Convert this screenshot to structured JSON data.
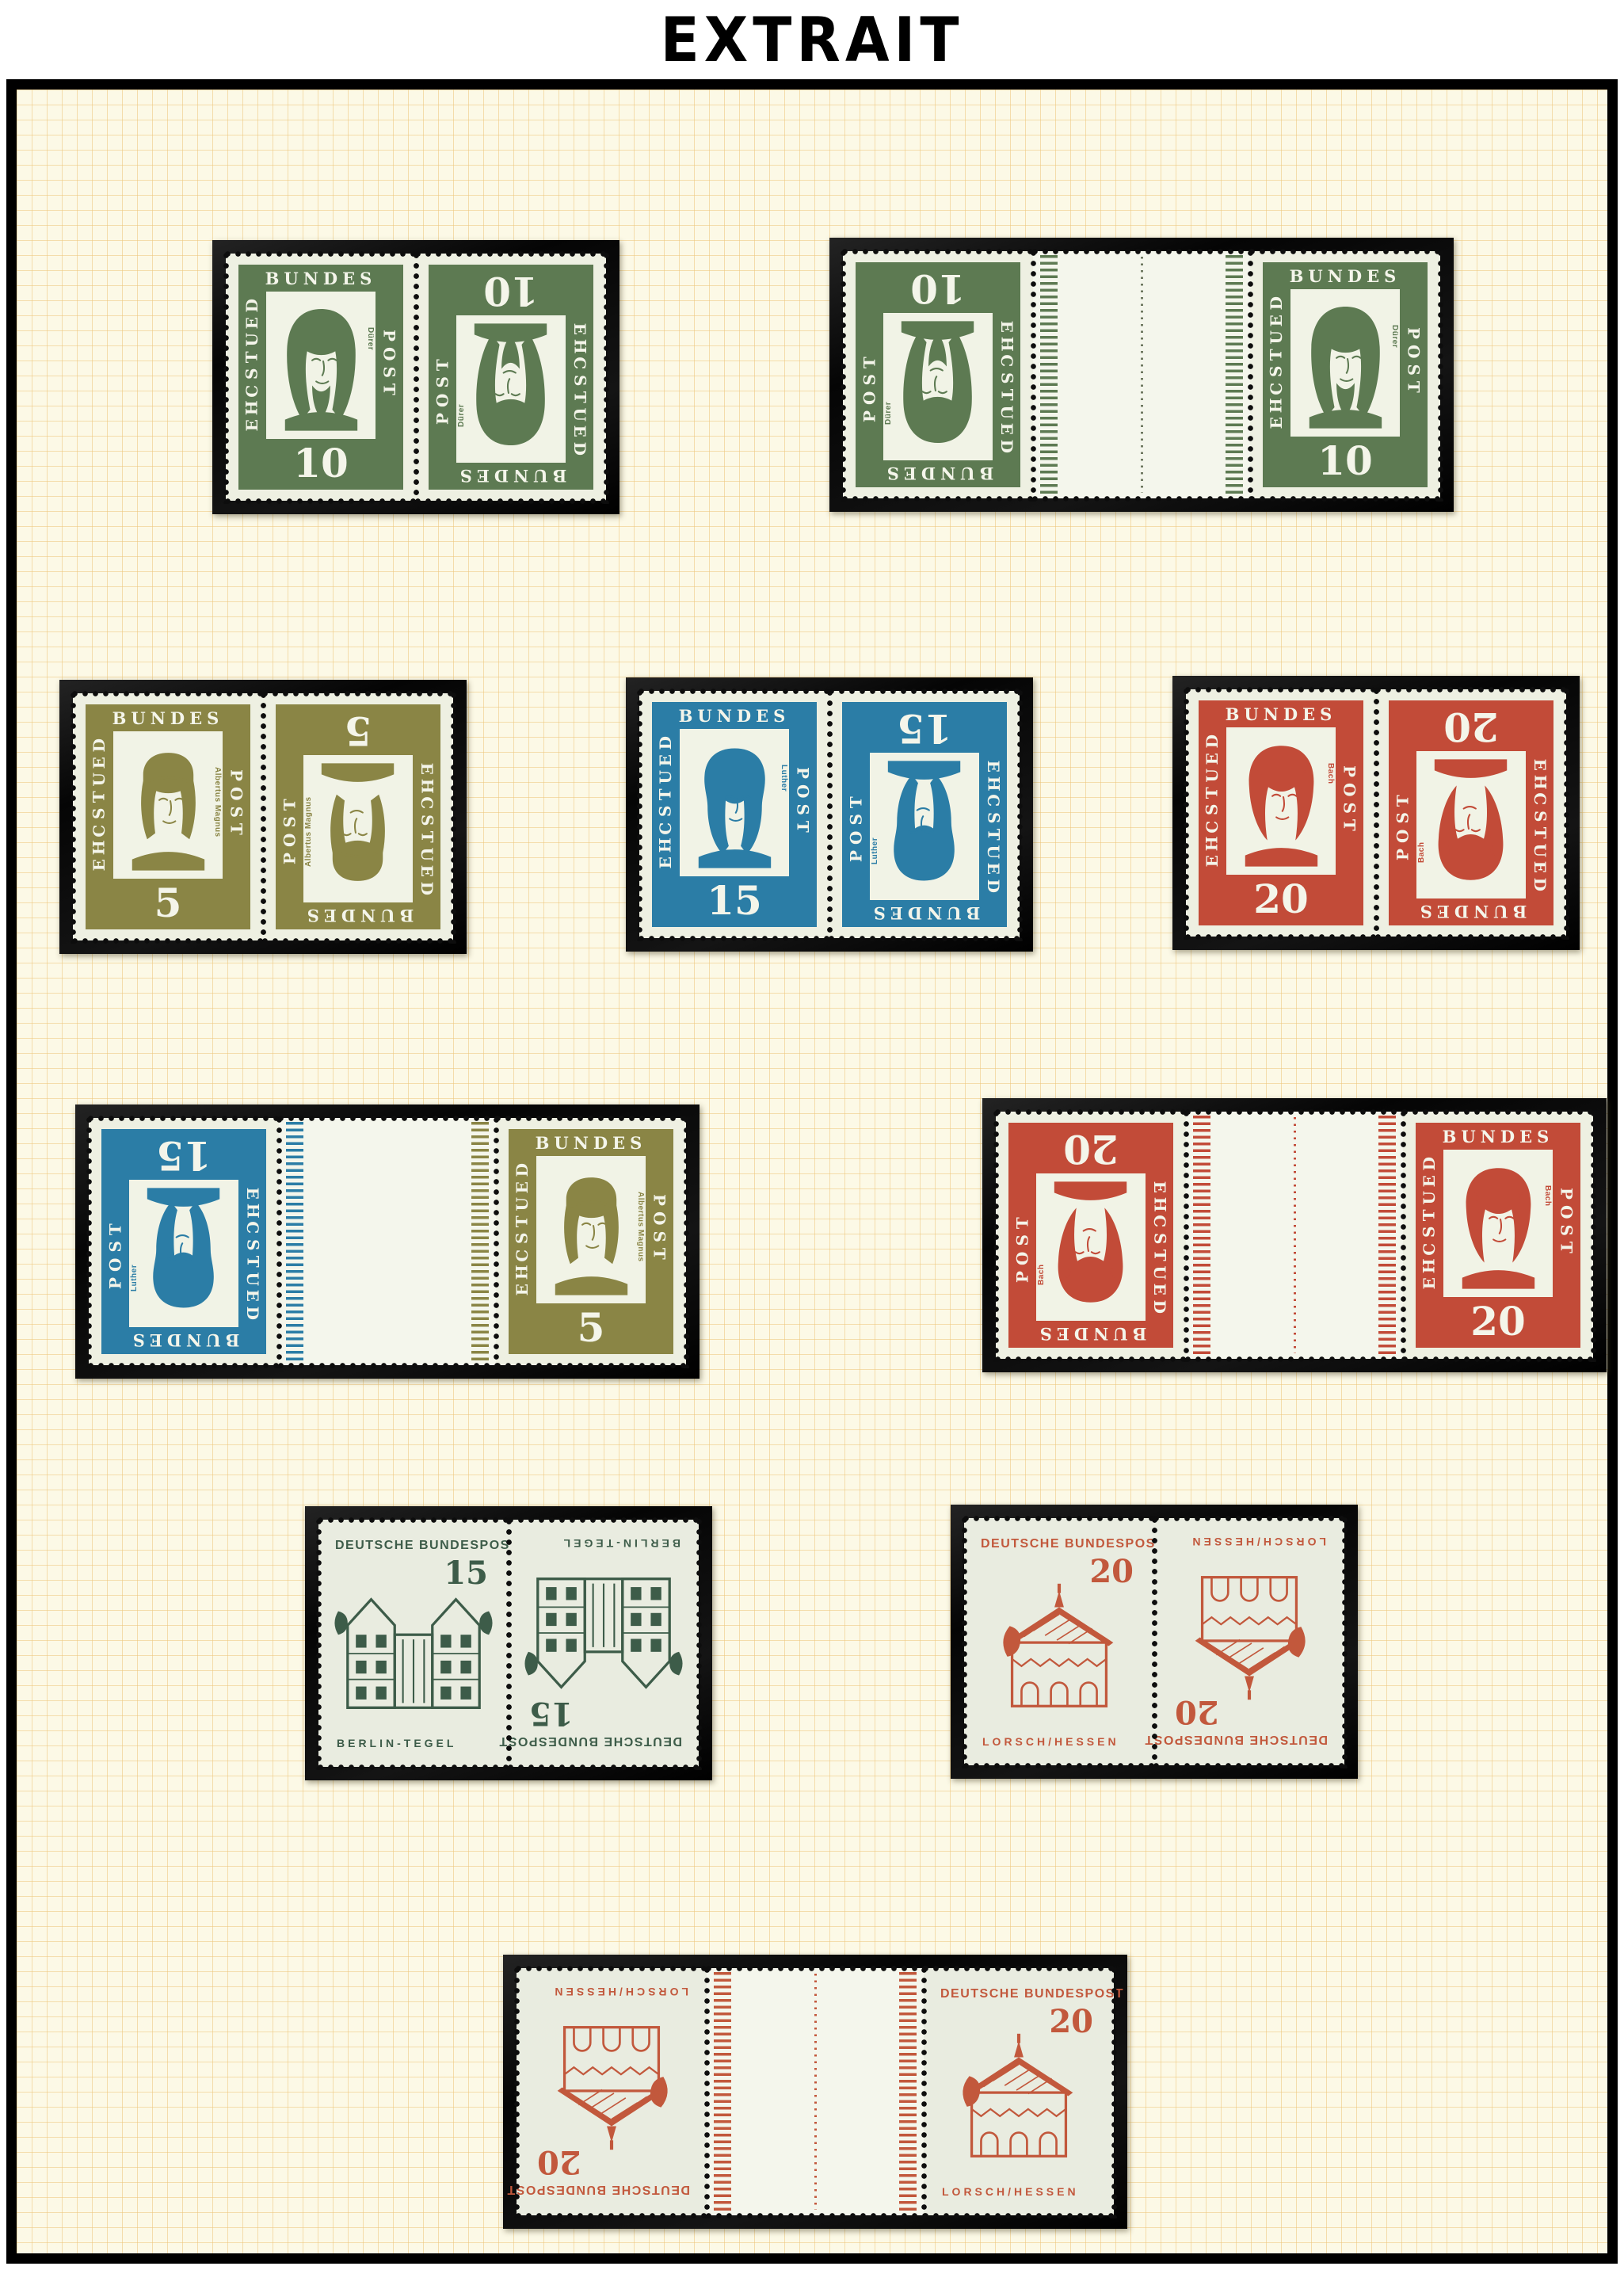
{
  "title": "EXTRAIT",
  "colors": {
    "page_background": "#ffffff",
    "frame_border": "#000000",
    "album_paper": "#fcf9e6",
    "grid_line": "#ecc67a",
    "mount_black": "#0d0d0d",
    "stamp_paper": "#eef0e2",
    "gutter_paper": "#f4f6ec"
  },
  "stamp_types": {
    "durer10": {
      "kind": "portrait",
      "value": "10",
      "name_label": "Dürer",
      "top_text": "BUNDES",
      "left_text": "DEUTSCHE",
      "right_text": "POST",
      "color": "#5d7a52"
    },
    "albertus5": {
      "kind": "portrait",
      "value": "5",
      "name_label": "Albertus Magnus",
      "top_text": "BUNDES",
      "left_text": "DEUTSCHE",
      "right_text": "POST",
      "color": "#8a8545"
    },
    "luther15": {
      "kind": "portrait",
      "value": "15",
      "name_label": "Luther",
      "top_text": "BUNDES",
      "left_text": "DEUTSCHE",
      "right_text": "POST",
      "color": "#2b7da6"
    },
    "bach20": {
      "kind": "portrait",
      "value": "20",
      "name_label": "Bach",
      "top_text": "BUNDES",
      "left_text": "DEUTSCHE",
      "right_text": "POST",
      "color": "#c24b38"
    },
    "tegel15": {
      "kind": "building",
      "value": "15",
      "header": "DEUTSCHE BUNDESPOST",
      "place": "BERLIN-TEGEL",
      "color": "#3d5c49"
    },
    "lorsch20": {
      "kind": "building",
      "value": "20",
      "header": "DEUTSCHE BUNDESPOST",
      "place": "LORSCH/HESSEN",
      "color": "#c2583c"
    }
  },
  "mounts": [
    {
      "id": "m1",
      "pair": "tete-beche",
      "left": "durer10",
      "left_inverted": false,
      "right": "durer10",
      "right_inverted": true
    },
    {
      "id": "m2",
      "pair": "gutter",
      "left": "durer10",
      "left_inverted": true,
      "right": "durer10",
      "right_inverted": false,
      "gutter_line": "#6e7860"
    },
    {
      "id": "m3",
      "pair": "tete-beche",
      "left": "albertus5",
      "left_inverted": false,
      "right": "albertus5",
      "right_inverted": true
    },
    {
      "id": "m4",
      "pair": "tete-beche",
      "left": "luther15",
      "left_inverted": false,
      "right": "luther15",
      "right_inverted": true
    },
    {
      "id": "m5",
      "pair": "tete-beche",
      "left": "bach20",
      "left_inverted": false,
      "right": "bach20",
      "right_inverted": true
    },
    {
      "id": "m6",
      "pair": "gutter",
      "left": "luther15",
      "left_inverted": true,
      "right": "albertus5",
      "right_inverted": false,
      "gutter_line": null
    },
    {
      "id": "m7",
      "pair": "gutter",
      "left": "bach20",
      "left_inverted": true,
      "right": "bach20",
      "right_inverted": false,
      "gutter_line": "#c24b38"
    },
    {
      "id": "m8",
      "pair": "tete-beche",
      "left": "tegel15",
      "left_inverted": false,
      "right": "tegel15",
      "right_inverted": true
    },
    {
      "id": "m9",
      "pair": "tete-beche",
      "left": "lorsch20",
      "left_inverted": false,
      "right": "lorsch20",
      "right_inverted": true
    },
    {
      "id": "m10",
      "pair": "gutter",
      "left": "lorsch20",
      "left_inverted": true,
      "right": "lorsch20",
      "right_inverted": false,
      "gutter_line": "#c2583c"
    }
  ]
}
